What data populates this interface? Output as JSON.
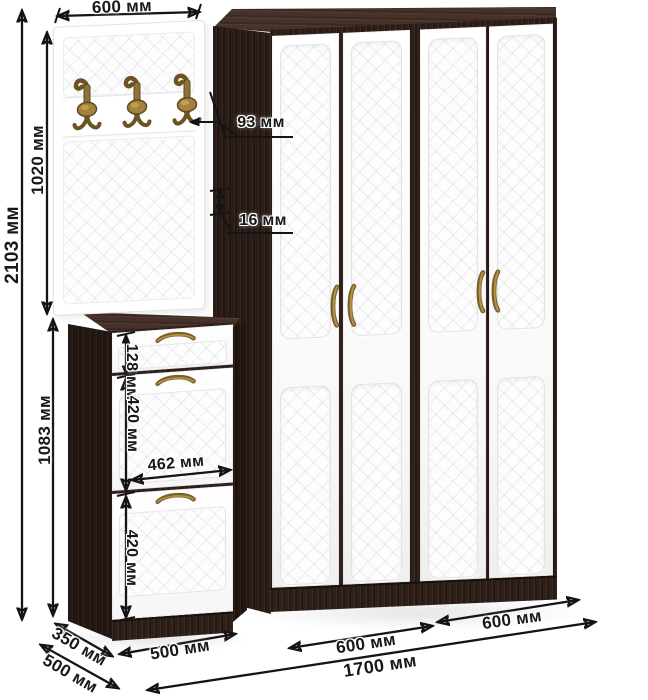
{
  "units": "мм",
  "annotations": {
    "hanger_width": "600 мм",
    "total_height": "2103 мм",
    "hanger_panel_height": "1020 мм",
    "hook_projection": "93 мм",
    "panel_thickness": "16 мм",
    "shoe_cabinet_height": "1083 мм",
    "drawer_front_height": "128 мм",
    "upper_door_height": "420 мм",
    "door_front_width": "462 мм",
    "lower_door_height": "420 мм",
    "shoe_cabinet_depth": "350 мм",
    "wardrobe_depth": "500 мм",
    "shoe_cabinet_width": "500 мм",
    "left_section_width": "600 мм",
    "right_section_width": "600 мм",
    "total_width": "1700 мм"
  },
  "colors": {
    "carcass_wenge": "#30201a",
    "carcass_wenge_top": "#463228",
    "facade_white": "#ffffff",
    "quilt_line": "#e7e7e7",
    "hardware_bronze": "#8f7336",
    "dimension_line": "#141414",
    "background": "#ffffff"
  },
  "icons": {
    "coat_hook": "bronze double coat hook with oval medallion",
    "door_handle": "bronze vertical bow handle",
    "drawer_handle": "bronze horizontal bow handle"
  }
}
